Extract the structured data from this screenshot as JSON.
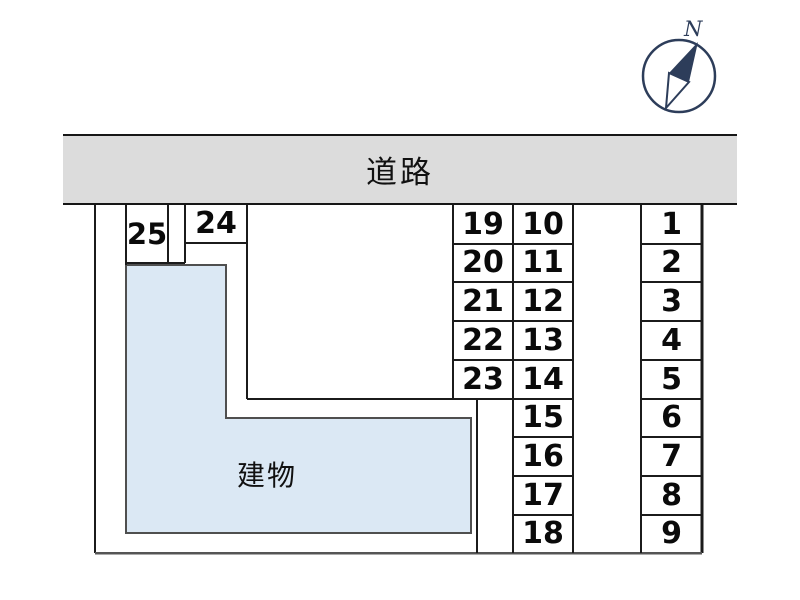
{
  "road": {
    "label": "道路"
  },
  "building": {
    "label": "建物"
  },
  "compass": {
    "north_label": "N"
  },
  "stalls": {
    "right_column": [
      "1",
      "2",
      "3",
      "4",
      "5",
      "6",
      "7",
      "8",
      "9"
    ],
    "middle_column": [
      "10",
      "11",
      "12",
      "13",
      "14",
      "15",
      "16",
      "17",
      "18"
    ],
    "inner_column": [
      "19",
      "20",
      "21",
      "22",
      "23"
    ],
    "top_stalls": [
      "24",
      "25"
    ]
  },
  "colors": {
    "road_fill": "#dcdcdc",
    "building_fill": "#dbe8f4",
    "grid_line": "#1b1b1b",
    "building_border": "#4f4f4f",
    "compass": "#2d3d5a",
    "text": "#0a0a0a"
  }
}
